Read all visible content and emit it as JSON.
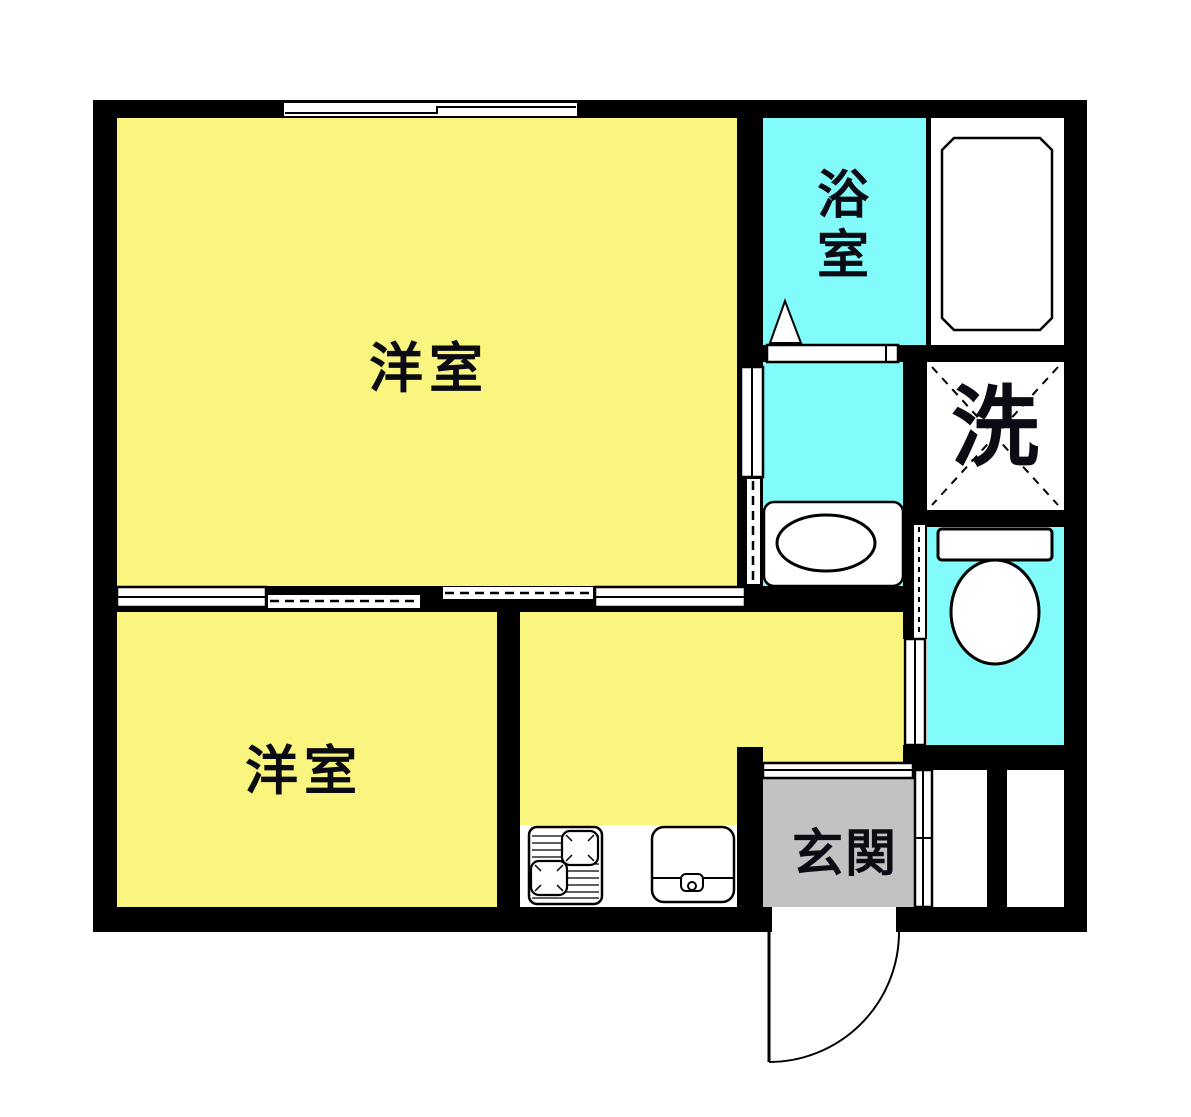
{
  "plan": {
    "rooms": {
      "living": {
        "label": "洋室"
      },
      "bedroom": {
        "label": "洋室"
      },
      "bathroom": {
        "label": "浴室"
      },
      "laundry": {
        "label": "洗"
      },
      "entrance": {
        "label": "玄関"
      }
    }
  },
  "colors": {
    "page_bg": "#FFFFFF",
    "wall": "#000000",
    "room_yellow": "#F9F57E",
    "wet_cyan": "#82FBFB",
    "genkan_gray": "#C2C2C2",
    "fixture_white": "#FFFFFF",
    "label_ink": "#0B0B14"
  }
}
